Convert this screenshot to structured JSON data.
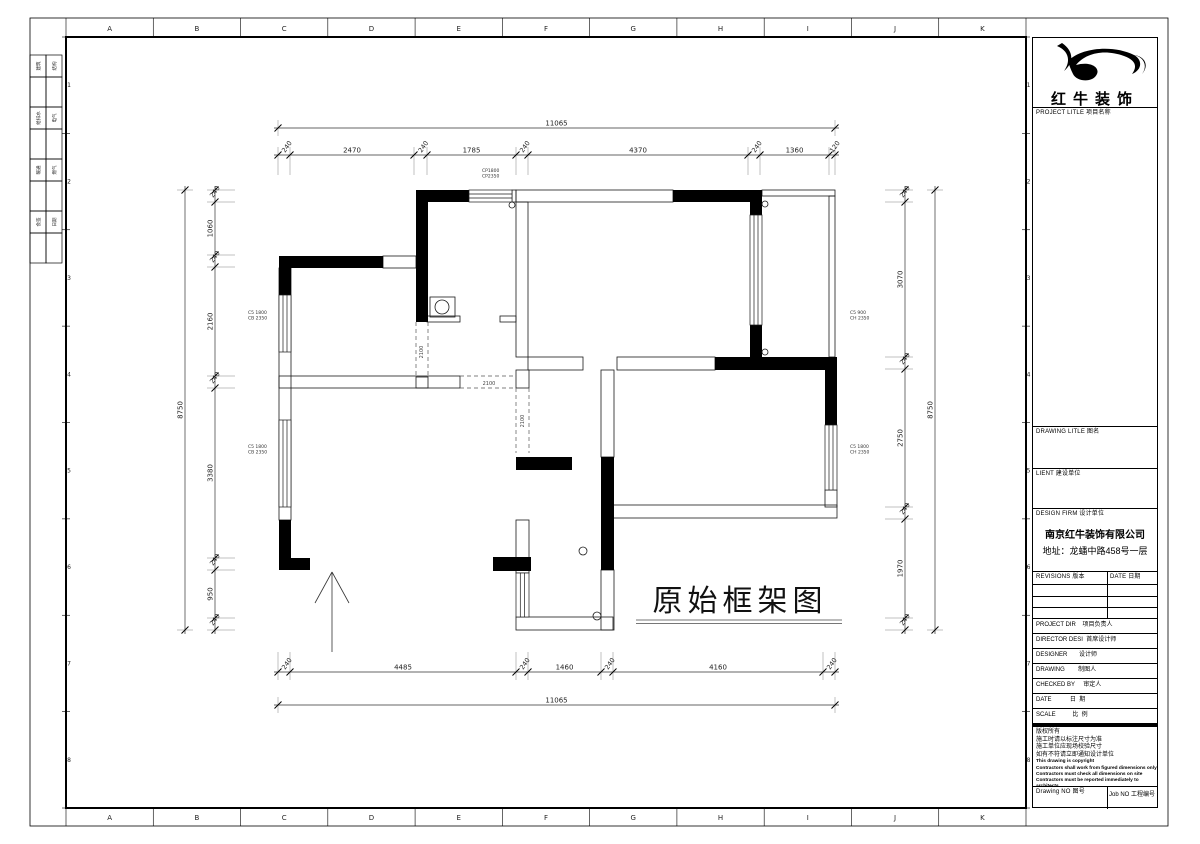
{
  "sheet": {
    "grid_letters": [
      "A",
      "B",
      "C",
      "D",
      "E",
      "F",
      "G",
      "H",
      "I",
      "J",
      "K"
    ],
    "grid_numbers": [
      "1",
      "2",
      "3",
      "4",
      "5",
      "6",
      "7",
      "8"
    ],
    "signoff_rows": [
      [
        "建筑",
        "结构"
      ],
      [
        "给排水",
        "电气"
      ],
      [
        "暖通",
        "燃气"
      ],
      [
        "会签",
        "日期"
      ]
    ]
  },
  "title_block": {
    "logo_text": "红牛装饰",
    "project_label": "PROJECT LITLE  项目名称",
    "drawing_label": "DRAWING LITLE  图名",
    "client_label": "LIENT  建设单位",
    "firm_label": "DESIGN FIRM  设计单位",
    "firm_name": "南京红牛装饰有限公司",
    "firm_address": "地址：龙蟠中路458号一层",
    "revisions_label": "REVISIONS  版本",
    "revisions_date_label": "DATE  日期",
    "rows": [
      "PROJECT DIR    项目负责人",
      "DIRECTOR DESI  首席设计师",
      "DESIGNER       设计师",
      "DRAWING        制图人",
      "CHECKED BY     审定人",
      "DATE           日  期",
      "SCALE          比  例"
    ],
    "copyright_cn": [
      "版权所有",
      "施工时请以标注尺寸为准",
      "施工单位应现场校验尺寸",
      "如有不符请立即通知设计单位"
    ],
    "copyright_en": [
      "This drawing is copyright",
      "Contractors shall work from figured dimensions only",
      "Contractors must check all dimensions on site",
      "Contractors must be reported immediately to architects"
    ],
    "drawing_no_label": "Drawing NO  图号",
    "job_no_label": "Job NO  工程编号"
  },
  "plan": {
    "title": "原始框架图",
    "door_labels": [
      "2100",
      "2100",
      "2100"
    ],
    "window_tags": [
      [
        "CP1800",
        "CP2350"
      ],
      [
        "C5 1800",
        "CB 2350"
      ],
      [
        "C5 1800",
        "CB 2350"
      ],
      [
        "C5 900",
        "CH 2350"
      ],
      [
        "C5 1800",
        "CH 2350"
      ]
    ],
    "dimensions": {
      "top_total": "11065",
      "top_segments": [
        "240",
        "2470",
        "240",
        "1785",
        "240",
        "4370",
        "240",
        "1360",
        "120"
      ],
      "bottom_total": "11065",
      "bottom_segments": [
        "240",
        "4485",
        "240",
        "1460",
        "240",
        "4160",
        "240"
      ],
      "left_total": "8750",
      "left_segments": [
        "240",
        "1060",
        "240",
        "2160",
        "240",
        "3380",
        "240",
        "950",
        "240"
      ],
      "right_total": "8750",
      "right_segments": [
        "240",
        "3070",
        "240",
        "2750",
        "240",
        "1970",
        "240"
      ]
    }
  }
}
